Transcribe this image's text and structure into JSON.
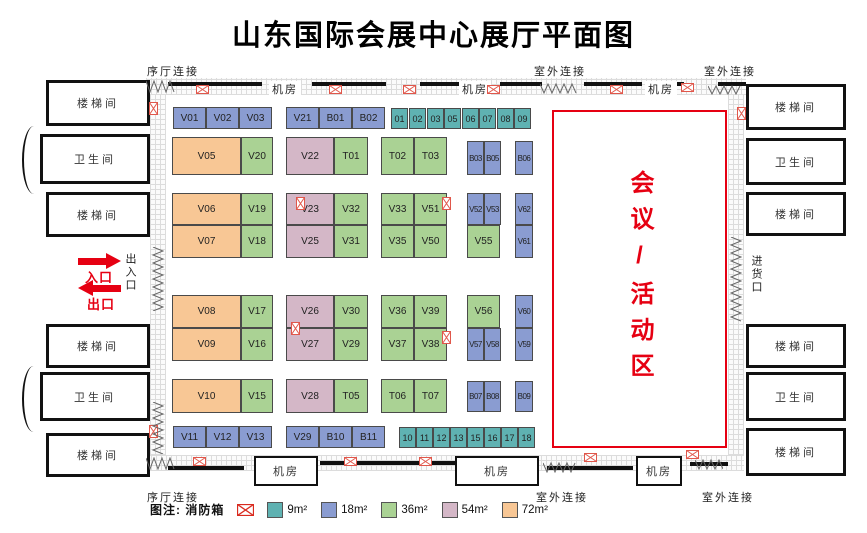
{
  "title": "山东国际会展中心展厅平面图",
  "colors": {
    "s9": "#5fb2b2",
    "s18": "#8a9cd1",
    "s36": "#aad294",
    "s54": "#d4b7c7",
    "s72": "#f8c795",
    "accent_red": "#e60012",
    "fire_red": "#e0574b",
    "wall_black": "#111111"
  },
  "conference": {
    "label": "会议/活动区"
  },
  "entrance": {
    "in_label": "入口",
    "out_label": "出口"
  },
  "legend": {
    "title": "图注: 消防箱",
    "items": [
      {
        "label": "9m²",
        "color": "#5fb2b2"
      },
      {
        "label": "18m²",
        "color": "#8a9cd1"
      },
      {
        "label": "36m²",
        "color": "#aad294"
      },
      {
        "label": "54m²",
        "color": "#d4b7c7"
      },
      {
        "label": "72m²",
        "color": "#f8c795"
      }
    ]
  },
  "rooms": [
    {
      "label": "楼梯间",
      "n": "stairs-left-1",
      "x": 46,
      "y": 80,
      "w": 104,
      "h": 46
    },
    {
      "label": "卫生间",
      "n": "restroom-left-1",
      "x": 40,
      "y": 134,
      "w": 110,
      "h": 50
    },
    {
      "label": "楼梯间",
      "n": "stairs-left-2",
      "x": 46,
      "y": 192,
      "w": 104,
      "h": 45
    },
    {
      "label": "楼梯间",
      "n": "stairs-left-3",
      "x": 46,
      "y": 324,
      "w": 104,
      "h": 44
    },
    {
      "label": "卫生间",
      "n": "restroom-left-2",
      "x": 40,
      "y": 372,
      "w": 110,
      "h": 49
    },
    {
      "label": "楼梯间",
      "n": "stairs-left-4",
      "x": 46,
      "y": 433,
      "w": 104,
      "h": 44
    },
    {
      "label": "楼梯间",
      "n": "stairs-right-1",
      "x": 746,
      "y": 84,
      "w": 100,
      "h": 46
    },
    {
      "label": "卫生间",
      "n": "restroom-right-1",
      "x": 746,
      "y": 138,
      "w": 100,
      "h": 47
    },
    {
      "label": "楼梯间",
      "n": "stairs-right-2",
      "x": 746,
      "y": 192,
      "w": 100,
      "h": 44
    },
    {
      "label": "楼梯间",
      "n": "stairs-right-3",
      "x": 746,
      "y": 324,
      "w": 100,
      "h": 44
    },
    {
      "label": "卫生间",
      "n": "restroom-right-2",
      "x": 746,
      "y": 372,
      "w": 100,
      "h": 49
    },
    {
      "label": "楼梯间",
      "n": "stairs-right-4",
      "x": 746,
      "y": 428,
      "w": 100,
      "h": 48
    }
  ],
  "machine_boxes": [
    {
      "label": "机房",
      "x": 254,
      "y": 456,
      "w": 64,
      "h": 30
    },
    {
      "label": "机房",
      "x": 455,
      "y": 456,
      "w": 84,
      "h": 30
    },
    {
      "label": "机房",
      "x": 636,
      "y": 456,
      "w": 46,
      "h": 30
    }
  ],
  "labels": [
    {
      "t": "序厅连接",
      "n": "lobby-connect-top",
      "x": 147,
      "y": 63
    },
    {
      "t": "室外连接",
      "n": "outdoor-connect-top-1",
      "x": 534,
      "y": 63
    },
    {
      "t": "室外连接",
      "n": "outdoor-connect-top-2",
      "x": 704,
      "y": 63
    },
    {
      "t": "机房",
      "n": "machine-room-top-1",
      "x": 269,
      "y": 81,
      "bg": 1
    },
    {
      "t": "机房",
      "n": "machine-room-top-2",
      "x": 459,
      "y": 81,
      "bg": 1
    },
    {
      "t": "机房",
      "n": "machine-room-top-3",
      "x": 645,
      "y": 81,
      "bg": 1
    },
    {
      "t": "序厅连接",
      "n": "lobby-connect-bottom",
      "x": 147,
      "y": 489
    },
    {
      "t": "室外连接",
      "n": "outdoor-connect-bottom-1",
      "x": 536,
      "y": 489
    },
    {
      "t": "室外连接",
      "n": "outdoor-connect-bottom-2",
      "x": 702,
      "y": 489
    }
  ],
  "vertical_labels": [
    {
      "t": "出入口",
      "n": "entrance-exit-label",
      "x": 122,
      "y": 253
    },
    {
      "t": "进货口",
      "n": "goods-entrance-label",
      "x": 748,
      "y": 255
    }
  ],
  "strips": [
    {
      "x": 146,
      "y": 78,
      "w": 600,
      "h": 17
    },
    {
      "x": 146,
      "y": 455,
      "w": 598,
      "h": 16
    },
    {
      "x": 150,
      "y": 95,
      "w": 16,
      "h": 360
    },
    {
      "x": 728,
      "y": 95,
      "w": 16,
      "h": 360
    }
  ],
  "wall_segments": [
    {
      "x": 168,
      "y": 82,
      "w": 94,
      "h": 4
    },
    {
      "x": 312,
      "y": 82,
      "w": 74,
      "h": 4
    },
    {
      "x": 420,
      "y": 82,
      "w": 46,
      "h": 4
    },
    {
      "x": 500,
      "y": 82,
      "w": 42,
      "h": 4
    },
    {
      "x": 584,
      "y": 82,
      "w": 58,
      "h": 4
    },
    {
      "x": 668,
      "y": 82,
      "w": 16,
      "h": 4
    },
    {
      "x": 718,
      "y": 82,
      "w": 28,
      "h": 4
    },
    {
      "x": 168,
      "y": 466,
      "w": 76,
      "h": 4
    },
    {
      "x": 320,
      "y": 461,
      "w": 136,
      "h": 4
    },
    {
      "x": 547,
      "y": 466,
      "w": 86,
      "h": 4
    },
    {
      "x": 690,
      "y": 462,
      "w": 38,
      "h": 4
    }
  ],
  "zigzags": [
    {
      "x": 146,
      "y": 80,
      "w": 30,
      "h": 13,
      "d": "h"
    },
    {
      "x": 146,
      "y": 457,
      "w": 30,
      "h": 13,
      "d": "h"
    },
    {
      "x": 540,
      "y": 83,
      "w": 38,
      "h": 11,
      "d": "h"
    },
    {
      "x": 708,
      "y": 85,
      "w": 34,
      "h": 10,
      "d": "h"
    },
    {
      "x": 543,
      "y": 462,
      "w": 34,
      "h": 11,
      "d": "h"
    },
    {
      "x": 695,
      "y": 459,
      "w": 28,
      "h": 11,
      "d": "h"
    },
    {
      "x": 152,
      "y": 247,
      "w": 12,
      "h": 64,
      "d": "v"
    },
    {
      "x": 152,
      "y": 402,
      "w": 12,
      "h": 52,
      "d": "v"
    },
    {
      "x": 730,
      "y": 237,
      "w": 12,
      "h": 86,
      "d": "v"
    }
  ],
  "fire_icons": [
    {
      "x": 196,
      "y": 85
    },
    {
      "x": 329,
      "y": 85
    },
    {
      "x": 403,
      "y": 85
    },
    {
      "x": 487,
      "y": 85
    },
    {
      "x": 610,
      "y": 85
    },
    {
      "x": 681,
      "y": 83
    },
    {
      "x": 193,
      "y": 457
    },
    {
      "x": 344,
      "y": 457
    },
    {
      "x": 419,
      "y": 457
    },
    {
      "x": 584,
      "y": 453
    },
    {
      "x": 686,
      "y": 450
    },
    {
      "x": 147,
      "y": 104,
      "v": 1
    },
    {
      "x": 147,
      "y": 427,
      "v": 1
    },
    {
      "x": 735,
      "y": 109,
      "v": 1
    },
    {
      "x": 294,
      "y": 199,
      "v": 1
    },
    {
      "x": 289,
      "y": 324,
      "v": 1
    },
    {
      "x": 440,
      "y": 199,
      "v": 1
    },
    {
      "x": 440,
      "y": 333,
      "v": 1
    }
  ],
  "booths": [
    {
      "id": "V01",
      "x": 173,
      "y": 107,
      "w": 33,
      "h": 22,
      "s": 18
    },
    {
      "id": "V02",
      "x": 206,
      "y": 107,
      "w": 33,
      "h": 22,
      "s": 18
    },
    {
      "id": "V03",
      "x": 239,
      "y": 107,
      "w": 33,
      "h": 22,
      "s": 18
    },
    {
      "id": "V21",
      "x": 286,
      "y": 107,
      "w": 33,
      "h": 22,
      "s": 18
    },
    {
      "id": "B01",
      "x": 319,
      "y": 107,
      "w": 33,
      "h": 22,
      "s": 18
    },
    {
      "id": "B02",
      "x": 352,
      "y": 107,
      "w": 33,
      "h": 22,
      "s": 18
    },
    {
      "id": "01",
      "x": 391,
      "y": 108,
      "w": 17,
      "h": 21,
      "s": 9
    },
    {
      "id": "02",
      "x": 409,
      "y": 108,
      "w": 17,
      "h": 21,
      "s": 9
    },
    {
      "id": "03",
      "x": 427,
      "y": 108,
      "w": 17,
      "h": 21,
      "s": 9
    },
    {
      "id": "05",
      "x": 444,
      "y": 108,
      "w": 17,
      "h": 21,
      "s": 9
    },
    {
      "id": "06",
      "x": 462,
      "y": 108,
      "w": 17,
      "h": 21,
      "s": 9
    },
    {
      "id": "07",
      "x": 479,
      "y": 108,
      "w": 17,
      "h": 21,
      "s": 9
    },
    {
      "id": "08",
      "x": 497,
      "y": 108,
      "w": 17,
      "h": 21,
      "s": 9
    },
    {
      "id": "09",
      "x": 514,
      "y": 108,
      "w": 17,
      "h": 21,
      "s": 9
    },
    {
      "id": "V05",
      "x": 172,
      "y": 137,
      "w": 69,
      "h": 38,
      "s": 72
    },
    {
      "id": "V20",
      "x": 241,
      "y": 137,
      "w": 32,
      "h": 38,
      "s": 36
    },
    {
      "id": "V22",
      "x": 286,
      "y": 137,
      "w": 48,
      "h": 38,
      "s": 54
    },
    {
      "id": "T01",
      "x": 334,
      "y": 137,
      "w": 34,
      "h": 38,
      "s": 36
    },
    {
      "id": "T02",
      "x": 381,
      "y": 137,
      "w": 33,
      "h": 38,
      "s": 36
    },
    {
      "id": "T03",
      "x": 414,
      "y": 137,
      "w": 33,
      "h": 38,
      "s": 36
    },
    {
      "id": "B03",
      "x": 467,
      "y": 141,
      "w": 17,
      "h": 34,
      "s": 18
    },
    {
      "id": "B05",
      "x": 484,
      "y": 141,
      "w": 17,
      "h": 34,
      "s": 18
    },
    {
      "id": "B06",
      "x": 515,
      "y": 141,
      "w": 18,
      "h": 34,
      "s": 18
    },
    {
      "id": "V06",
      "x": 172,
      "y": 193,
      "w": 69,
      "h": 32,
      "s": 72
    },
    {
      "id": "V19",
      "x": 241,
      "y": 193,
      "w": 32,
      "h": 32,
      "s": 36
    },
    {
      "id": "V23",
      "x": 286,
      "y": 193,
      "w": 48,
      "h": 32,
      "s": 54
    },
    {
      "id": "V32",
      "x": 334,
      "y": 193,
      "w": 34,
      "h": 32,
      "s": 36
    },
    {
      "id": "V33",
      "x": 381,
      "y": 193,
      "w": 33,
      "h": 32,
      "s": 36
    },
    {
      "id": "V51",
      "x": 414,
      "y": 193,
      "w": 33,
      "h": 32,
      "s": 36
    },
    {
      "id": "V52",
      "x": 467,
      "y": 193,
      "w": 17,
      "h": 32,
      "s": 18
    },
    {
      "id": "V53",
      "x": 484,
      "y": 193,
      "w": 17,
      "h": 32,
      "s": 18
    },
    {
      "id": "V62",
      "x": 515,
      "y": 193,
      "w": 18,
      "h": 32,
      "s": 18
    },
    {
      "id": "V07",
      "x": 172,
      "y": 225,
      "w": 69,
      "h": 33,
      "s": 72
    },
    {
      "id": "V18",
      "x": 241,
      "y": 225,
      "w": 32,
      "h": 33,
      "s": 36
    },
    {
      "id": "V25",
      "x": 286,
      "y": 225,
      "w": 48,
      "h": 33,
      "s": 54
    },
    {
      "id": "V31",
      "x": 334,
      "y": 225,
      "w": 34,
      "h": 33,
      "s": 36
    },
    {
      "id": "V35",
      "x": 381,
      "y": 225,
      "w": 33,
      "h": 33,
      "s": 36
    },
    {
      "id": "V50",
      "x": 414,
      "y": 225,
      "w": 33,
      "h": 33,
      "s": 36
    },
    {
      "id": "V55",
      "x": 467,
      "y": 225,
      "w": 33,
      "h": 33,
      "s": 36
    },
    {
      "id": "V61",
      "x": 515,
      "y": 225,
      "w": 18,
      "h": 33,
      "s": 18
    },
    {
      "id": "V08",
      "x": 172,
      "y": 295,
      "w": 69,
      "h": 33,
      "s": 72
    },
    {
      "id": "V17",
      "x": 241,
      "y": 295,
      "w": 32,
      "h": 33,
      "s": 36
    },
    {
      "id": "V26",
      "x": 286,
      "y": 295,
      "w": 48,
      "h": 33,
      "s": 54
    },
    {
      "id": "V30",
      "x": 334,
      "y": 295,
      "w": 34,
      "h": 33,
      "s": 36
    },
    {
      "id": "V36",
      "x": 381,
      "y": 295,
      "w": 33,
      "h": 33,
      "s": 36
    },
    {
      "id": "V39",
      "x": 414,
      "y": 295,
      "w": 33,
      "h": 33,
      "s": 36
    },
    {
      "id": "V56",
      "x": 467,
      "y": 295,
      "w": 33,
      "h": 33,
      "s": 36
    },
    {
      "id": "V60",
      "x": 515,
      "y": 295,
      "w": 18,
      "h": 33,
      "s": 18
    },
    {
      "id": "V09",
      "x": 172,
      "y": 328,
      "w": 69,
      "h": 33,
      "s": 72
    },
    {
      "id": "V16",
      "x": 241,
      "y": 328,
      "w": 32,
      "h": 33,
      "s": 36
    },
    {
      "id": "V27",
      "x": 286,
      "y": 328,
      "w": 48,
      "h": 33,
      "s": 54
    },
    {
      "id": "V29",
      "x": 334,
      "y": 328,
      "w": 34,
      "h": 33,
      "s": 36
    },
    {
      "id": "V37",
      "x": 381,
      "y": 328,
      "w": 33,
      "h": 33,
      "s": 36
    },
    {
      "id": "V38",
      "x": 414,
      "y": 328,
      "w": 33,
      "h": 33,
      "s": 36
    },
    {
      "id": "V57",
      "x": 467,
      "y": 328,
      "w": 17,
      "h": 33,
      "s": 18
    },
    {
      "id": "V58",
      "x": 484,
      "y": 328,
      "w": 17,
      "h": 33,
      "s": 18
    },
    {
      "id": "V59",
      "x": 515,
      "y": 328,
      "w": 18,
      "h": 33,
      "s": 18
    },
    {
      "id": "V10",
      "x": 172,
      "y": 379,
      "w": 69,
      "h": 34,
      "s": 72
    },
    {
      "id": "V15",
      "x": 241,
      "y": 379,
      "w": 32,
      "h": 34,
      "s": 36
    },
    {
      "id": "V28",
      "x": 286,
      "y": 379,
      "w": 48,
      "h": 34,
      "s": 54
    },
    {
      "id": "T05",
      "x": 334,
      "y": 379,
      "w": 34,
      "h": 34,
      "s": 36
    },
    {
      "id": "T06",
      "x": 381,
      "y": 379,
      "w": 33,
      "h": 34,
      "s": 36
    },
    {
      "id": "T07",
      "x": 414,
      "y": 379,
      "w": 33,
      "h": 34,
      "s": 36
    },
    {
      "id": "B07",
      "x": 467,
      "y": 381,
      "w": 17,
      "h": 31,
      "s": 18
    },
    {
      "id": "B08",
      "x": 484,
      "y": 381,
      "w": 17,
      "h": 31,
      "s": 18
    },
    {
      "id": "B09",
      "x": 515,
      "y": 381,
      "w": 18,
      "h": 31,
      "s": 18
    },
    {
      "id": "V11",
      "x": 173,
      "y": 426,
      "w": 33,
      "h": 22,
      "s": 18
    },
    {
      "id": "V12",
      "x": 206,
      "y": 426,
      "w": 33,
      "h": 22,
      "s": 18
    },
    {
      "id": "V13",
      "x": 239,
      "y": 426,
      "w": 33,
      "h": 22,
      "s": 18
    },
    {
      "id": "V29",
      "x": 286,
      "y": 426,
      "w": 33,
      "h": 22,
      "s": 18
    },
    {
      "id": "B10",
      "x": 319,
      "y": 426,
      "w": 33,
      "h": 22,
      "s": 18
    },
    {
      "id": "B11",
      "x": 352,
      "y": 426,
      "w": 33,
      "h": 22,
      "s": 18
    },
    {
      "id": "10",
      "x": 399,
      "y": 427,
      "w": 17,
      "h": 21,
      "s": 9
    },
    {
      "id": "11",
      "x": 416,
      "y": 427,
      "w": 17,
      "h": 21,
      "s": 9
    },
    {
      "id": "12",
      "x": 433,
      "y": 427,
      "w": 17,
      "h": 21,
      "s": 9
    },
    {
      "id": "13",
      "x": 450,
      "y": 427,
      "w": 17,
      "h": 21,
      "s": 9
    },
    {
      "id": "15",
      "x": 467,
      "y": 427,
      "w": 17,
      "h": 21,
      "s": 9
    },
    {
      "id": "16",
      "x": 484,
      "y": 427,
      "w": 17,
      "h": 21,
      "s": 9
    },
    {
      "id": "17",
      "x": 501,
      "y": 427,
      "w": 17,
      "h": 21,
      "s": 9
    },
    {
      "id": "18",
      "x": 518,
      "y": 427,
      "w": 17,
      "h": 21,
      "s": 9
    }
  ]
}
